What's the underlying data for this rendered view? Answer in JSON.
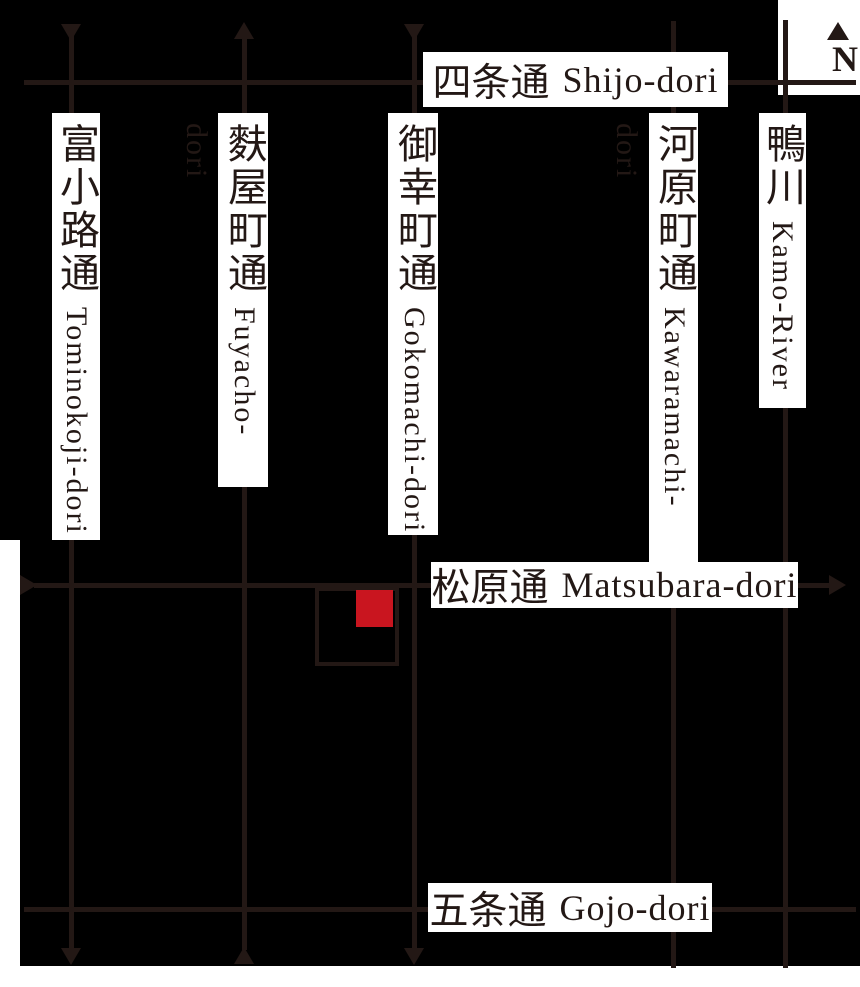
{
  "map": {
    "compass": {
      "north_label": "N"
    },
    "colors": {
      "background": "#000000",
      "road": "#231815",
      "label_background": "#ffffff",
      "text": "#231815",
      "marker_red": "#c9151f"
    },
    "vertical_roads": [
      {
        "kanji": "富小路通",
        "romaji": "Tominokoji-dori",
        "one_way": "south"
      },
      {
        "kanji": "麩屋町通",
        "romaji": "Fuyacho-dori",
        "one_way": "north"
      },
      {
        "kanji": "御幸町通",
        "romaji": "Gokomachi-dori",
        "one_way": "south"
      },
      {
        "kanji": "河原町通",
        "romaji": "Kawaramachi-dori",
        "one_way": null
      },
      {
        "kanji": "鴨川",
        "romaji": "Kamo-River",
        "one_way": null
      }
    ],
    "horizontal_roads": [
      {
        "kanji": "四条通",
        "romaji": "Shijo-dori",
        "one_way": null
      },
      {
        "kanji": "松原通",
        "romaji": "Matsubara-dori",
        "one_way": "east"
      },
      {
        "kanji": "五条通",
        "romaji": "Gojo-dori",
        "one_way": null
      }
    ],
    "marker": {
      "shape": "square",
      "color": "#c9151f"
    }
  }
}
